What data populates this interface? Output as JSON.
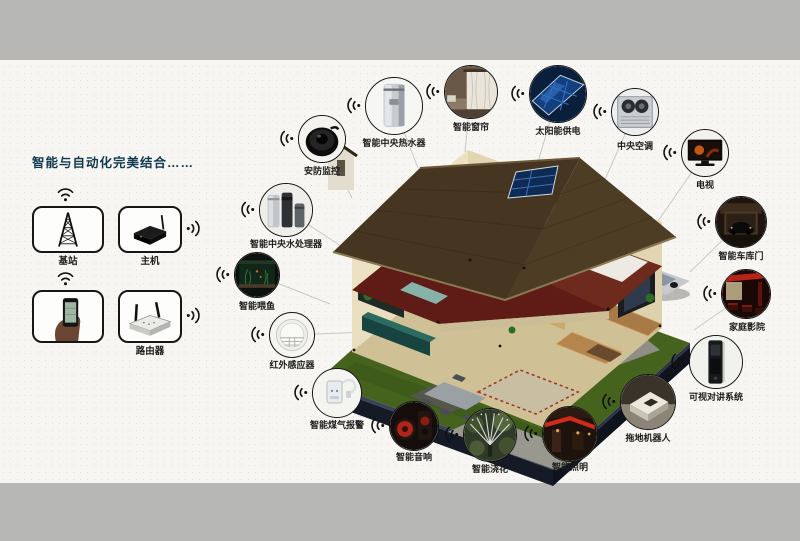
{
  "intro": {
    "title": "智能与自动化完美结合……"
  },
  "hub": {
    "items": [
      {
        "id": "base-station",
        "label": "基站"
      },
      {
        "id": "host",
        "label": "主机"
      },
      {
        "id": "smartphone",
        "label": ""
      },
      {
        "id": "router",
        "label": "路由器"
      }
    ]
  },
  "devices": [
    {
      "id": "security-camera",
      "label": "安防监控"
    },
    {
      "id": "central-water-heater",
      "label": "智能中央热水器"
    },
    {
      "id": "smart-curtains",
      "label": "智能窗帘"
    },
    {
      "id": "solar-power",
      "label": "太阳能供电"
    },
    {
      "id": "central-ac",
      "label": "中央空调"
    },
    {
      "id": "tv",
      "label": "电视"
    },
    {
      "id": "garage-door",
      "label": "智能车库门"
    },
    {
      "id": "home-theater",
      "label": "家庭影院"
    },
    {
      "id": "video-intercom",
      "label": "可视对讲系统"
    },
    {
      "id": "mopping-robot",
      "label": "拖地机器人"
    },
    {
      "id": "smart-lighting",
      "label": "智能照明"
    },
    {
      "id": "smart-watering",
      "label": "智能浇花"
    },
    {
      "id": "smart-audio",
      "label": "智能音响"
    },
    {
      "id": "gas-alarm",
      "label": "智能煤气报警"
    },
    {
      "id": "infrared-sensor",
      "label": "红外感应器"
    },
    {
      "id": "fish-feeding",
      "label": "智能喂鱼"
    },
    {
      "id": "central-water-processor",
      "label": "智能中央水处理器"
    }
  ],
  "colors": {
    "title": "#10384f",
    "gray_band": "#b7b7b5",
    "connector_line": "#c9c8c3"
  }
}
